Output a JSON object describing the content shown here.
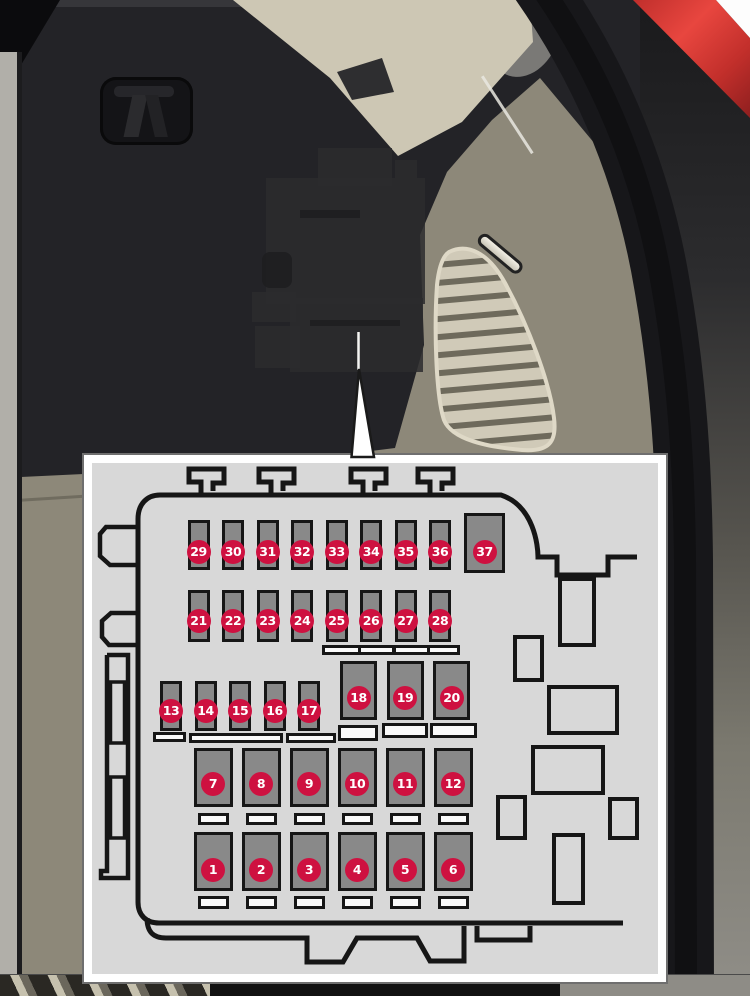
{
  "scene": {
    "description": "Owner's manual illustration: fuse box behind side panel in cargo area, with enlarged fuse panel diagram",
    "colors": {
      "badge_red": "#ce1140",
      "fuse_gray": "#898989",
      "diagram_bg": "#d8d8d8",
      "outline_black": "#161616",
      "panel_olive": "#8d8879",
      "trim_beige": "#cdc7b4",
      "body_red": "#e8463f"
    }
  },
  "fuse_panel": {
    "fuses": [
      {
        "n": 1,
        "x": 193.5,
        "y": 832,
        "w": 39,
        "h": 59,
        "cy": 870
      },
      {
        "n": 2,
        "x": 241.5,
        "y": 832,
        "w": 39,
        "h": 59,
        "cy": 870
      },
      {
        "n": 3,
        "x": 289.5,
        "y": 832,
        "w": 39,
        "h": 59,
        "cy": 870
      },
      {
        "n": 4,
        "x": 337.5,
        "y": 832,
        "w": 39,
        "h": 59,
        "cy": 870
      },
      {
        "n": 5,
        "x": 385.5,
        "y": 832,
        "w": 39,
        "h": 59,
        "cy": 870
      },
      {
        "n": 6,
        "x": 433.5,
        "y": 832,
        "w": 39,
        "h": 59,
        "cy": 870
      },
      {
        "n": 7,
        "x": 193.5,
        "y": 748,
        "w": 39,
        "h": 59,
        "cy": 784
      },
      {
        "n": 8,
        "x": 241.5,
        "y": 748,
        "w": 39,
        "h": 59,
        "cy": 784
      },
      {
        "n": 9,
        "x": 289.5,
        "y": 748,
        "w": 39,
        "h": 59,
        "cy": 784
      },
      {
        "n": 10,
        "x": 337.5,
        "y": 748,
        "w": 39,
        "h": 59,
        "cy": 784
      },
      {
        "n": 11,
        "x": 385.5,
        "y": 748,
        "w": 39,
        "h": 59,
        "cy": 784
      },
      {
        "n": 12,
        "x": 433.5,
        "y": 748,
        "w": 39,
        "h": 59,
        "cy": 784
      },
      {
        "n": 13,
        "x": 160,
        "y": 681,
        "w": 22,
        "h": 50,
        "cy": 711
      },
      {
        "n": 14,
        "x": 194.5,
        "y": 681,
        "w": 22,
        "h": 50,
        "cy": 711
      },
      {
        "n": 15,
        "x": 229,
        "y": 681,
        "w": 22,
        "h": 50,
        "cy": 711
      },
      {
        "n": 16,
        "x": 263.5,
        "y": 681,
        "w": 22,
        "h": 50,
        "cy": 711
      },
      {
        "n": 17,
        "x": 298,
        "y": 681,
        "w": 22,
        "h": 50,
        "cy": 711
      },
      {
        "n": 18,
        "x": 340,
        "y": 661,
        "w": 37,
        "h": 59,
        "cy": 698
      },
      {
        "n": 19,
        "x": 386.5,
        "y": 661,
        "w": 37,
        "h": 59,
        "cy": 698
      },
      {
        "n": 20,
        "x": 433,
        "y": 661,
        "w": 37,
        "h": 59,
        "cy": 698
      },
      {
        "n": 21,
        "x": 187.5,
        "y": 590,
        "w": 22,
        "h": 52,
        "cy": 621
      },
      {
        "n": 22,
        "x": 222,
        "y": 590,
        "w": 22,
        "h": 52,
        "cy": 621
      },
      {
        "n": 23,
        "x": 256.5,
        "y": 590,
        "w": 22,
        "h": 52,
        "cy": 621
      },
      {
        "n": 24,
        "x": 291,
        "y": 590,
        "w": 22,
        "h": 52,
        "cy": 621
      },
      {
        "n": 25,
        "x": 325.5,
        "y": 590,
        "w": 22,
        "h": 52,
        "cy": 621
      },
      {
        "n": 26,
        "x": 360,
        "y": 590,
        "w": 22,
        "h": 52,
        "cy": 621
      },
      {
        "n": 27,
        "x": 394.5,
        "y": 590,
        "w": 22,
        "h": 52,
        "cy": 621
      },
      {
        "n": 28,
        "x": 429,
        "y": 590,
        "w": 22,
        "h": 52,
        "cy": 621
      },
      {
        "n": 29,
        "x": 187.5,
        "y": 520,
        "w": 22,
        "h": 50,
        "cy": 552
      },
      {
        "n": 30,
        "x": 222,
        "y": 520,
        "w": 22,
        "h": 50,
        "cy": 552
      },
      {
        "n": 31,
        "x": 256.5,
        "y": 520,
        "w": 22,
        "h": 50,
        "cy": 552
      },
      {
        "n": 32,
        "x": 291,
        "y": 520,
        "w": 22,
        "h": 50,
        "cy": 552
      },
      {
        "n": 33,
        "x": 325.5,
        "y": 520,
        "w": 22,
        "h": 50,
        "cy": 552
      },
      {
        "n": 34,
        "x": 360,
        "y": 520,
        "w": 22,
        "h": 50,
        "cy": 552
      },
      {
        "n": 35,
        "x": 394.5,
        "y": 520,
        "w": 22,
        "h": 50,
        "cy": 552
      },
      {
        "n": 36,
        "x": 429,
        "y": 520,
        "w": 22,
        "h": 50,
        "cy": 552
      },
      {
        "n": 37,
        "x": 464,
        "y": 513,
        "w": 41,
        "h": 60,
        "cy": 552
      }
    ],
    "relay_slots": [
      {
        "x": 558,
        "y": 577,
        "w": 38,
        "h": 70
      },
      {
        "x": 513,
        "y": 635,
        "w": 31,
        "h": 47
      },
      {
        "x": 547,
        "y": 685,
        "w": 72,
        "h": 50
      },
      {
        "x": 531,
        "y": 745,
        "w": 74,
        "h": 50
      },
      {
        "x": 496,
        "y": 795,
        "w": 31,
        "h": 45
      },
      {
        "x": 608,
        "y": 797,
        "w": 31,
        "h": 43
      },
      {
        "x": 552,
        "y": 833,
        "w": 33,
        "h": 72
      }
    ],
    "terminal_bars": [
      {
        "x": 153,
        "y": 732,
        "w": 33,
        "h": 10
      },
      {
        "x": 189,
        "y": 733,
        "w": 94,
        "h": 10
      },
      {
        "x": 286,
        "y": 733,
        "w": 50,
        "h": 10
      },
      {
        "x": 338,
        "y": 725,
        "w": 40,
        "h": 16
      },
      {
        "x": 382,
        "y": 723,
        "w": 46,
        "h": 15
      },
      {
        "x": 430,
        "y": 723,
        "w": 47,
        "h": 15
      },
      {
        "x": 197.5,
        "y": 813,
        "w": 31,
        "h": 12
      },
      {
        "x": 245.5,
        "y": 813,
        "w": 31,
        "h": 12
      },
      {
        "x": 293.5,
        "y": 813,
        "w": 31,
        "h": 12
      },
      {
        "x": 341.5,
        "y": 813,
        "w": 31,
        "h": 12
      },
      {
        "x": 389.5,
        "y": 813,
        "w": 31,
        "h": 12
      },
      {
        "x": 437.5,
        "y": 813,
        "w": 31,
        "h": 12
      },
      {
        "x": 197.5,
        "y": 896,
        "w": 31,
        "h": 13
      },
      {
        "x": 245.5,
        "y": 896,
        "w": 31,
        "h": 13
      },
      {
        "x": 293.5,
        "y": 896,
        "w": 31,
        "h": 13
      },
      {
        "x": 341.5,
        "y": 896,
        "w": 31,
        "h": 13
      },
      {
        "x": 389.5,
        "y": 896,
        "w": 31,
        "h": 13
      },
      {
        "x": 437.5,
        "y": 896,
        "w": 31,
        "h": 13
      }
    ],
    "segmented_bar": {
      "x": 322,
      "y": 645,
      "w": 138,
      "h": 10,
      "segments": 4
    }
  }
}
